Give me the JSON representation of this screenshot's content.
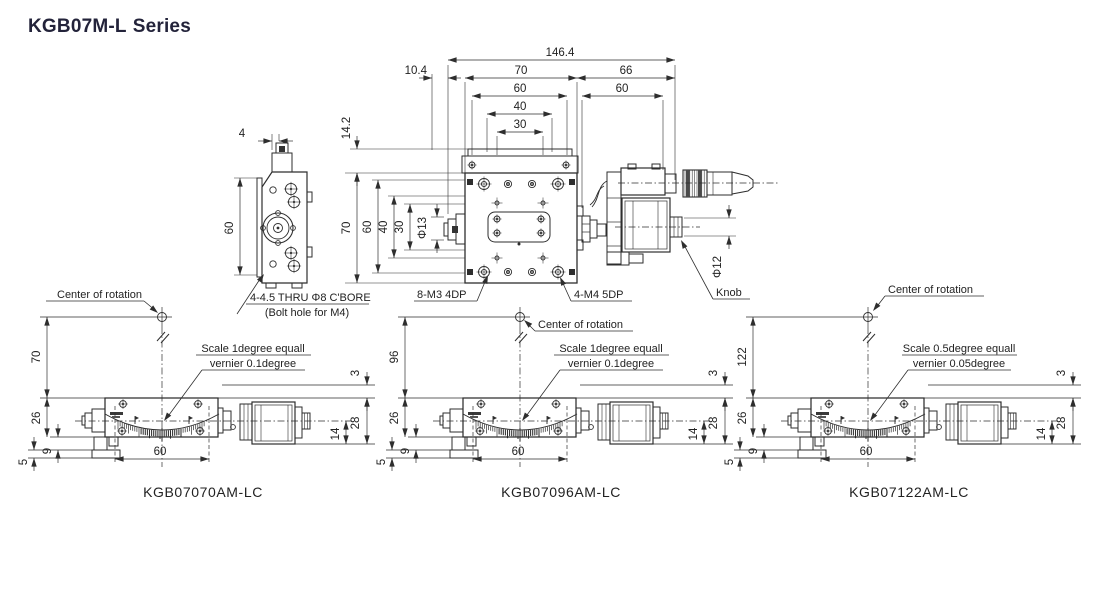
{
  "title": {
    "model": "KGB07M-L",
    "series": "Series"
  },
  "top_view": {
    "dim_overall": "146.4",
    "dim_offset": "10.4",
    "dim_stage_width": "70",
    "dim_head_length": "66",
    "dim_platform_width": "60",
    "dim_head_span": "60",
    "dim_hole_span_40": "40",
    "dim_hole_span_30": "30",
    "dim_height_offset": "14.2",
    "dim_stage_depth": "70",
    "dim_side_60": "60",
    "dim_side_40": "40",
    "dim_side_30": "30",
    "dim_phi13": "Φ13",
    "dim_phi12": "Φ12",
    "callout_m3": "8-M3 4DP",
    "callout_m4": "4-M4 5DP",
    "callout_knob": "Knob"
  },
  "side_view": {
    "dim_width": "4",
    "dim_height": "60",
    "callout_cbore": "4-4.5 THRU Φ8 C'BORE",
    "callout_bolt": "(Bolt hole for M4)"
  },
  "gonio_views": [
    {
      "model": "KGB07070AM-LC",
      "center_label": "Center of rotation",
      "scale_note_line1": "Scale 1degree equall",
      "scale_note_line2": "vernier 0.1degree",
      "dim_center_height": "70",
      "dim_stage_height": "26",
      "dim_foot": "9",
      "dim_base": "5",
      "dim_hole_span": "60",
      "dim_knob_offset": "14",
      "dim_body_height": "28",
      "dim_top_clearance": "3"
    },
    {
      "model": "KGB07096AM-LC",
      "center_label": "Center of rotation",
      "scale_note_line1": "Scale 1degree equall",
      "scale_note_line2": "vernier 0.1degree",
      "dim_center_height": "96",
      "dim_stage_height": "26",
      "dim_foot": "9",
      "dim_base": "5",
      "dim_hole_span": "60",
      "dim_knob_offset": "14",
      "dim_body_height": "28",
      "dim_top_clearance": "3"
    },
    {
      "model": "KGB07122AM-LC",
      "center_label": "Center of rotation",
      "scale_note_line1": "Scale 0.5degree equall",
      "scale_note_line2": "vernier 0.05degree",
      "dim_center_height": "122",
      "dim_stage_height": "26",
      "dim_foot": "9",
      "dim_base": "5",
      "dim_hole_span": "60",
      "dim_knob_offset": "14",
      "dim_body_height": "28",
      "dim_top_clearance": "3"
    }
  ]
}
